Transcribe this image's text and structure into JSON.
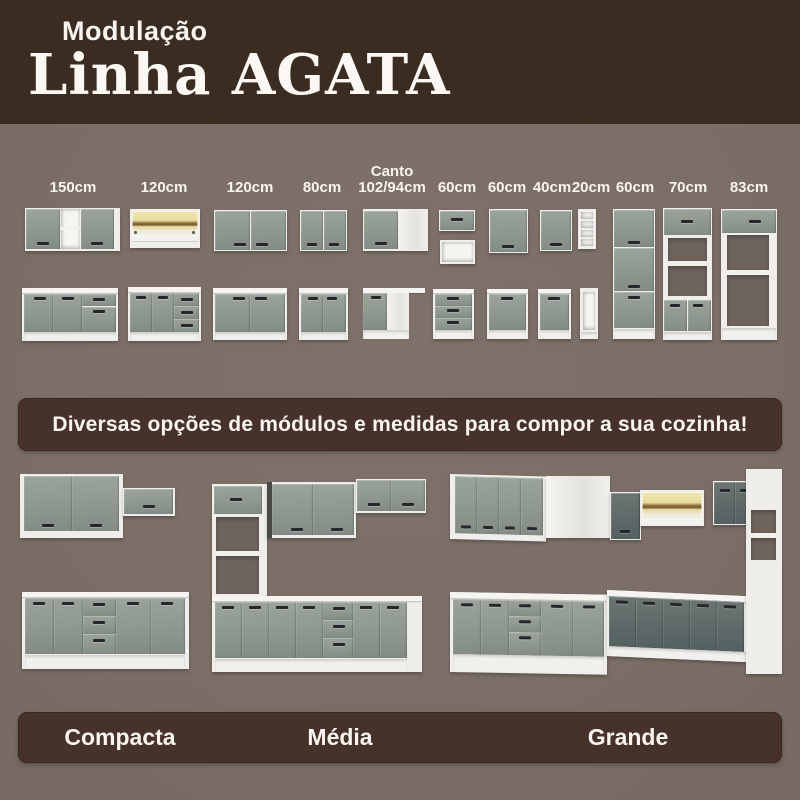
{
  "header": {
    "subtitle": "Modulação",
    "title": "Linha AGATA"
  },
  "modules": {
    "items": [
      {
        "label": "150cm",
        "type": "wall-cabinet-2-doors-open-niche"
      },
      {
        "label": "120cm",
        "type": "wall-glass-cristaleira"
      },
      {
        "label": "120cm",
        "type": "wall-cabinet-2-doors"
      },
      {
        "label": "80cm",
        "type": "wall-cabinet-2-doors"
      },
      {
        "label": "Canto",
        "label2": "102/94cm",
        "type": "corner-cabinet"
      },
      {
        "label": "60cm",
        "type": "flip-door-wall-cabinet-plus-niche"
      },
      {
        "label": "60cm",
        "type": "wall-cabinet-1-door"
      },
      {
        "label": "40cm",
        "type": "wall-cabinet-1-door"
      },
      {
        "label": "20cm",
        "type": "open-shelf-tower"
      },
      {
        "label": "60cm",
        "type": "tall-pantry-cabinet"
      },
      {
        "label": "70cm",
        "type": "tall-oven-tower"
      },
      {
        "label": "83cm",
        "type": "tall-fridge-surround"
      }
    ]
  },
  "banner": {
    "text": "Diversas opções de módulos e medidas para compor a sua cozinha!"
  },
  "kitchens": {
    "items": [
      {
        "label": "Compacta"
      },
      {
        "label": "Média"
      },
      {
        "label": "Grande"
      }
    ]
  },
  "colors": {
    "header_bg": "#3A2C21",
    "body_bg": "#7C6F68",
    "panel_bg": "#46322A",
    "cabinet_gray": "#8F998F",
    "cabinet_dark_gray": "#5D6968",
    "carcass_white": "#EFEEEB",
    "glass_yellow": "#E8DC9E",
    "handle_dark": "#26272A",
    "text_light": "#F8F5F1"
  }
}
